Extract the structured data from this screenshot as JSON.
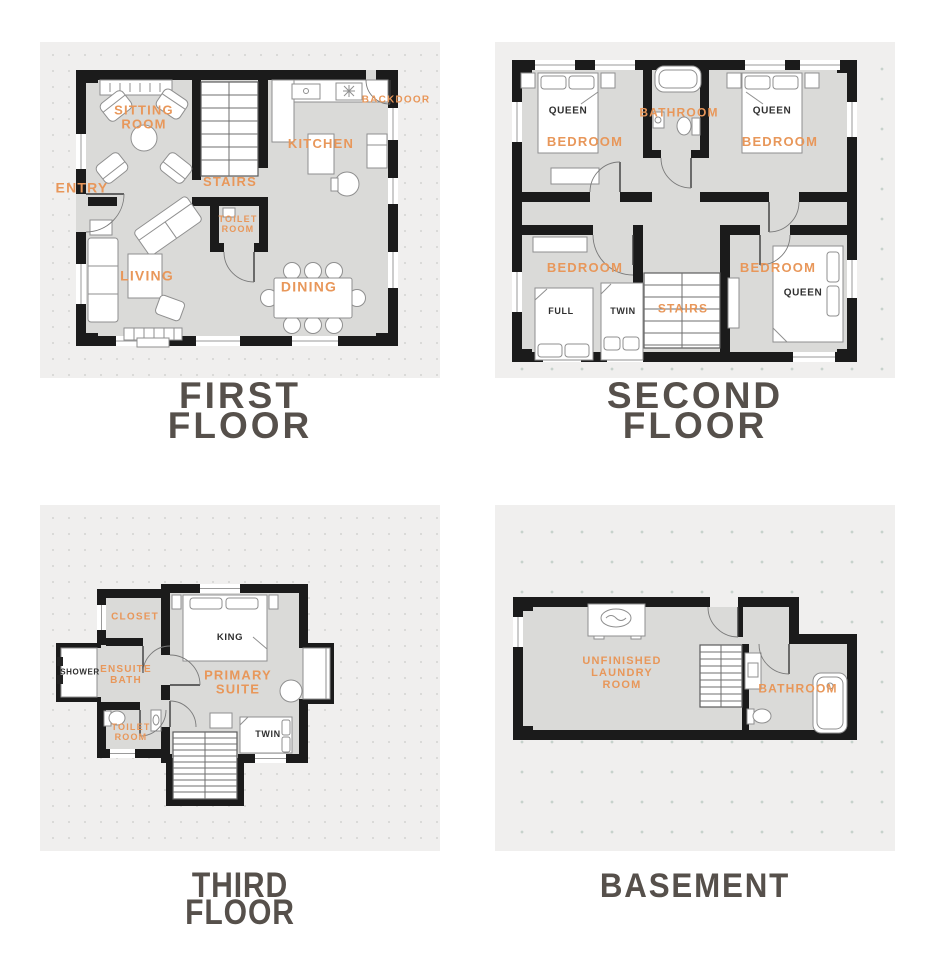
{
  "colors": {
    "label_orange": "#E8975A",
    "title_gray": "#56504B",
    "wall_black": "#1B1B1B",
    "floor_gray": "#DADAD8",
    "panel_background": "#F0EFEE"
  },
  "floors": {
    "first": {
      "title": "FIRST\nFLOOR",
      "rooms": {
        "sitting_room": "SITTING\nROOM",
        "entry": "ENTRY",
        "stairs": "STAIRS",
        "kitchen": "KITCHEN",
        "backdoor": "BACKDOOR",
        "toilet_room": "TOILET\nROOM",
        "living": "LIVING",
        "dining": "DINING"
      }
    },
    "second": {
      "title": "SECOND\nFLOOR",
      "rooms": {
        "bedroom_tl": "BEDROOM",
        "bathroom": "BATHROOM",
        "bedroom_tr": "BEDROOM",
        "bedroom_bl": "BEDROOM",
        "stairs": "STAIRS",
        "bedroom_br": "BEDROOM"
      },
      "furniture": {
        "queen_tl": "QUEEN",
        "queen_tr": "QUEEN",
        "full": "FULL",
        "twin": "TWIN",
        "queen_br": "QUEEN"
      }
    },
    "third": {
      "title": "THIRD\nFLOOR",
      "rooms": {
        "closet": "CLOSET",
        "ensuite_bath": "ENSUITE\nBATH",
        "primary_suite": "PRIMARY\nSUITE",
        "toilet_room": "TOILET\nROOM"
      },
      "furniture": {
        "king": "KING",
        "shower": "SHOWER",
        "twin": "TWIN"
      }
    },
    "basement": {
      "title": "BASEMENT",
      "rooms": {
        "laundry": "UNFINISHED\nLAUNDRY\nROOM",
        "bathroom": "BATHROOM"
      }
    }
  }
}
